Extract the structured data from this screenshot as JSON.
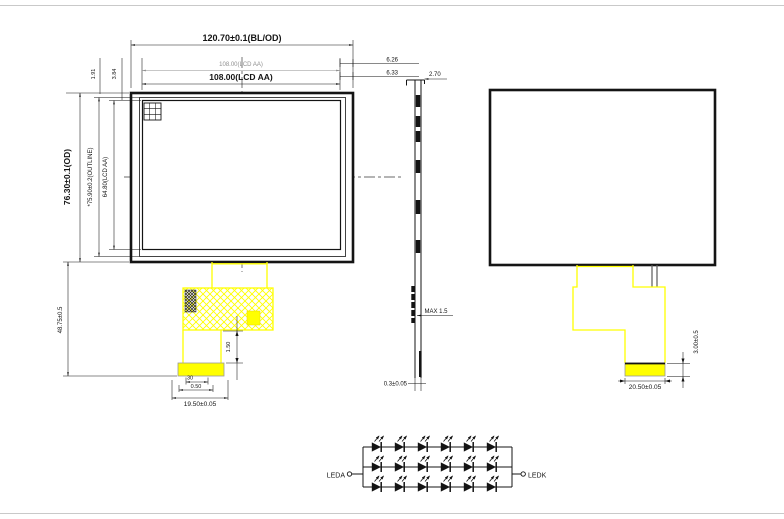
{
  "front_view": {
    "dim_width_od": "120.70±0.1(BL/OD)",
    "dim_width_aa_small": "108.00(LCD AA)",
    "dim_width_aa": "108.00(LCD AA)",
    "dim_margin_right_1": "6.26",
    "dim_margin_right_2": "6.33",
    "dim_height_od": "76.30±0.1(OD)",
    "dim_height_outline": "*75.90±0.2(OUTLINE)",
    "dim_height_aa": "64.80(LCD AA)",
    "dim_corner_offset_1": "1.91",
    "dim_corner_offset_2": "3.84",
    "dim_fpc_length": "48.75±0.5",
    "dim_fpc_tail": "1.50",
    "dim_pin_count": "30",
    "dim_pin_pitch": "0.50",
    "dim_connector_width": "19.50±0.05"
  },
  "side_view": {
    "dim_thickness": "2.70",
    "dim_component_height": "MAX 1.5",
    "dim_fpc_thickness": "0.3±0.05"
  },
  "back_view": {
    "dim_connector_height": "3.00±0.5",
    "dim_connector_width": "20.50±0.05"
  },
  "led_circuit": {
    "anode_label": "LEDA",
    "cathode_label": "LEDK",
    "rows": 3,
    "leds_per_row": 6
  },
  "colors": {
    "fpc_yellow": "#ffff00",
    "line_black": "#141414"
  }
}
